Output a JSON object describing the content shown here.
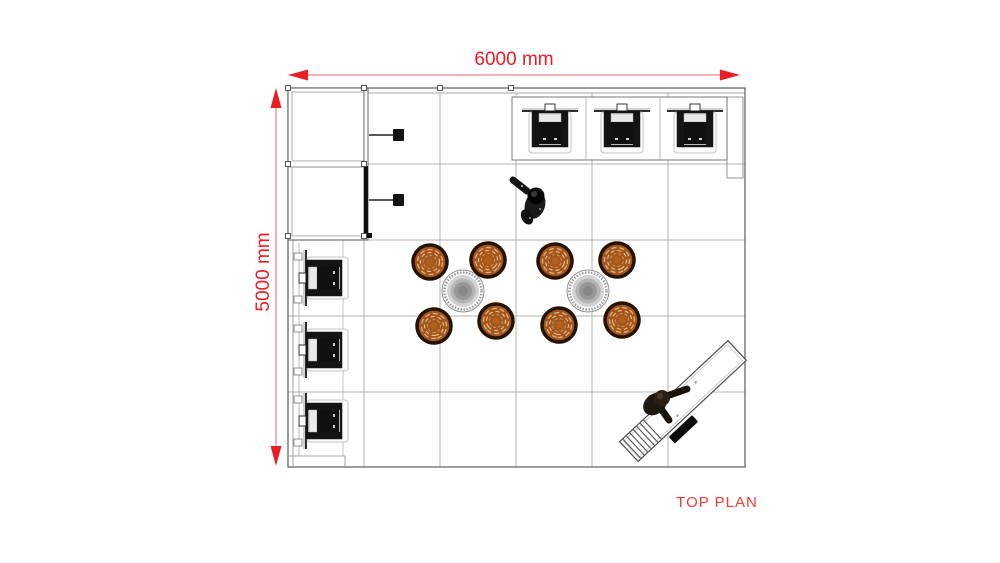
{
  "title": "TOP PLAN",
  "dimensions": {
    "horizontal": {
      "label": "6000 mm",
      "value_mm": 6000
    },
    "vertical": {
      "label": "5000 mm",
      "value_mm": 5000
    }
  },
  "colors": {
    "dimension_red": "#EC1C24",
    "dimension_line_red": "#F08080",
    "chair_orange": "#A4561B",
    "chair_ring_brown": "#251302",
    "chair_weave_tan": "#DDB488",
    "table_gray": "#8F8F8F",
    "wall_line_dark": "#555555",
    "floor_grid_gray": "#B3B3B3",
    "display_screen_black": "#101010",
    "figure_dark": "#1A1A1A",
    "desk_white": "#FFFFFF",
    "background": "#FFFFFF"
  },
  "plan": {
    "view": "top-down floor plan",
    "floor_grid": {
      "columns": 6,
      "rows": 5
    },
    "rooms": [
      {
        "name": "storage-closet",
        "location": "top-left",
        "cells": 2
      }
    ],
    "furniture": [
      {
        "name": "wall-mounted-display",
        "location": "top wall",
        "count": 3
      },
      {
        "name": "wall-mounted-display",
        "location": "left wall",
        "count": 3
      },
      {
        "name": "round-table",
        "count": 2
      },
      {
        "name": "wicker-chair",
        "count": 8
      },
      {
        "name": "wall-fixture-bracket",
        "location": "closet wall",
        "count": 2
      },
      {
        "name": "reception-desk",
        "location": "bottom-right diagonal",
        "count": 1
      },
      {
        "name": "person",
        "count": 2
      }
    ]
  }
}
